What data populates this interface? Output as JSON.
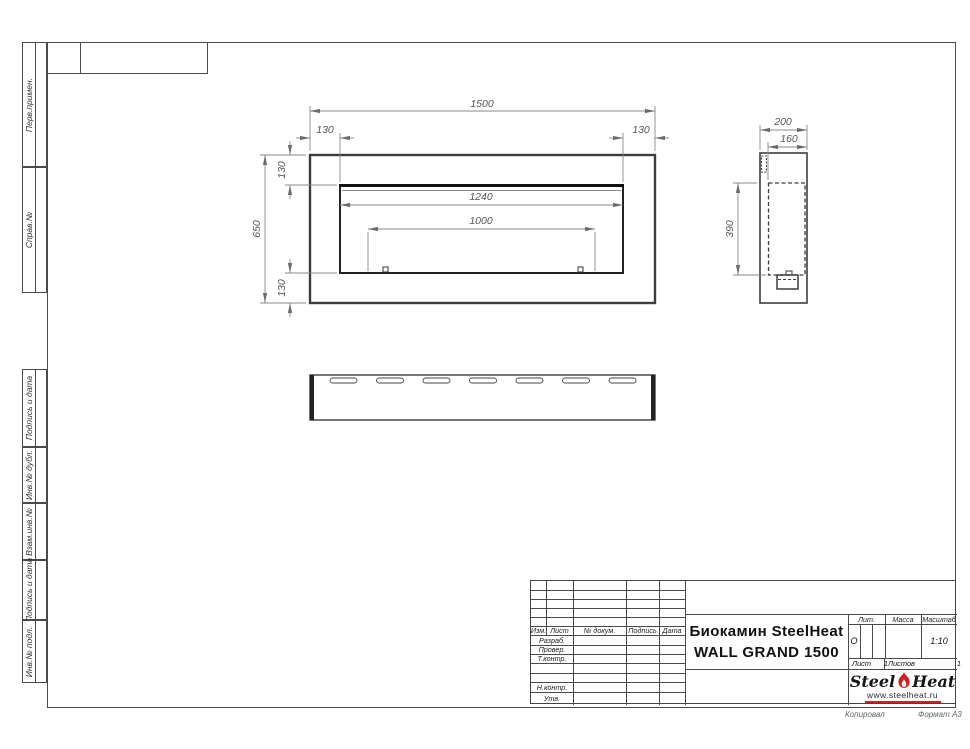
{
  "doc": {
    "format_note": "Формат А3",
    "copy_note": "Копировал"
  },
  "left_margin": {
    "blocks": [
      "Перв.примен.",
      "Справ.№",
      "Подпись и дата",
      "Инв.№ дубл.",
      "Взам.инв.№",
      "Подпись и дата",
      "Инв.№ подл."
    ]
  },
  "dims": {
    "front": {
      "total_width": "1500",
      "flange_left": "130",
      "flange_right": "130",
      "total_height": "650",
      "flange_top": "130",
      "flange_bottom": "130",
      "opening_width": "1240",
      "burner_length": "1000"
    },
    "side": {
      "depth": "200",
      "inner_depth": "160",
      "opening_height": "390"
    }
  },
  "title_block": {
    "header_cols": [
      "Изм.",
      "Лист",
      "№ докум.",
      "Подпись",
      "Дата"
    ],
    "row_labels": [
      "Разраб.",
      "Провер.",
      "Т.контр.",
      "Н.контр.",
      "Утв."
    ],
    "title_line1": "Биокамин SteelHeat",
    "title_line2": "WALL GRAND 1500",
    "lit_label": "Лит.",
    "lit_value": "О",
    "mass_label": "Масса",
    "scale_label": "Масштаб",
    "scale_value": "1:10",
    "sheet_label": "Лист",
    "sheet_value": "1",
    "sheets_label": "Листов",
    "sheets_value": "1",
    "logo": {
      "steel": "Steel",
      "heat": "Heat",
      "url": "www.steelheat.ru"
    }
  },
  "colors": {
    "outline": "#3d3d3d",
    "dim": "#787878",
    "accent_red": "#cf1f1f"
  }
}
